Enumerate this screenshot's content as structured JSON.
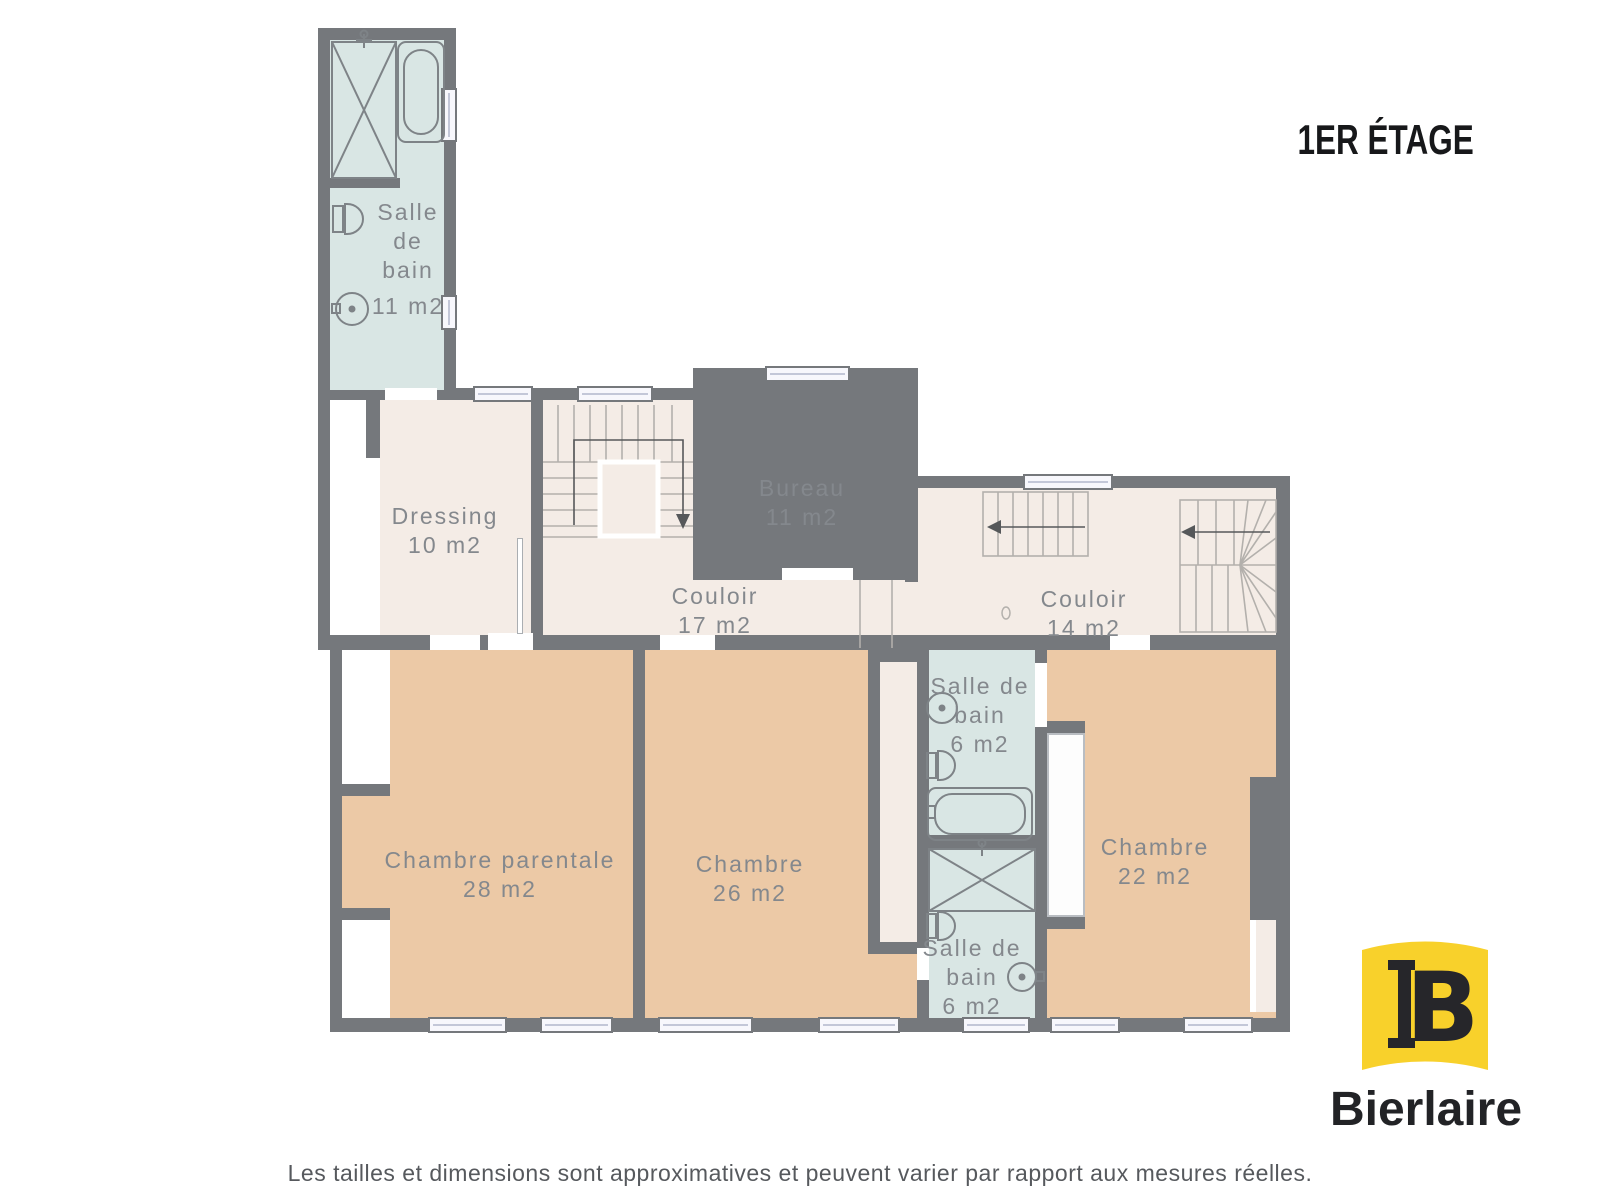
{
  "title": "1ER ÉTAGE",
  "rooms": [
    {
      "name": "Salle de bain",
      "area": "11 m2"
    },
    {
      "name": "Dressing",
      "area": "10 m2"
    },
    {
      "name": "Bureau",
      "area": "11 m2"
    },
    {
      "name": "Couloir",
      "area": "17 m2"
    },
    {
      "name": "Couloir",
      "area": "14 m2"
    },
    {
      "name": "Chambre parentale",
      "area": "28 m2"
    },
    {
      "name": "Chambre",
      "area": "26 m2"
    },
    {
      "name": "Salle de bain",
      "area": "6 m2"
    },
    {
      "name": "Chambre",
      "area": "22 m2"
    },
    {
      "name": "Salle de bain",
      "area": "6 m2"
    }
  ],
  "bathroom_fixtures": {
    "salle_de_bain_11": [
      "shower",
      "bathtub",
      "toilet",
      "sink"
    ],
    "salle_de_bain_6_middle": [
      "sink",
      "toilet",
      "bathtub"
    ],
    "salle_de_bain_6_bottom": [
      "shower",
      "toilet",
      "sink"
    ]
  },
  "stairs": [
    "main-u-staircase",
    "straight-staircase",
    "winder-staircase"
  ],
  "logo": {
    "brand": "Bierlaire",
    "monogram_letter": "B"
  },
  "disclaimer": "Les tailles et dimensions sont approximatives et peuvent varier par rapport aux mesures réelles.",
  "colors": {
    "wall": "#75787c",
    "room": "#f4ece6",
    "bedroom": "#ecc9a6",
    "bathroom": "#d9e6e4",
    "label": "#84888d",
    "window": "#f7f7fc",
    "title": "#17181a",
    "logo_yellow": "#f8d12b",
    "logo_dark": "#26262a",
    "disclaimer_text": "#56595d"
  }
}
